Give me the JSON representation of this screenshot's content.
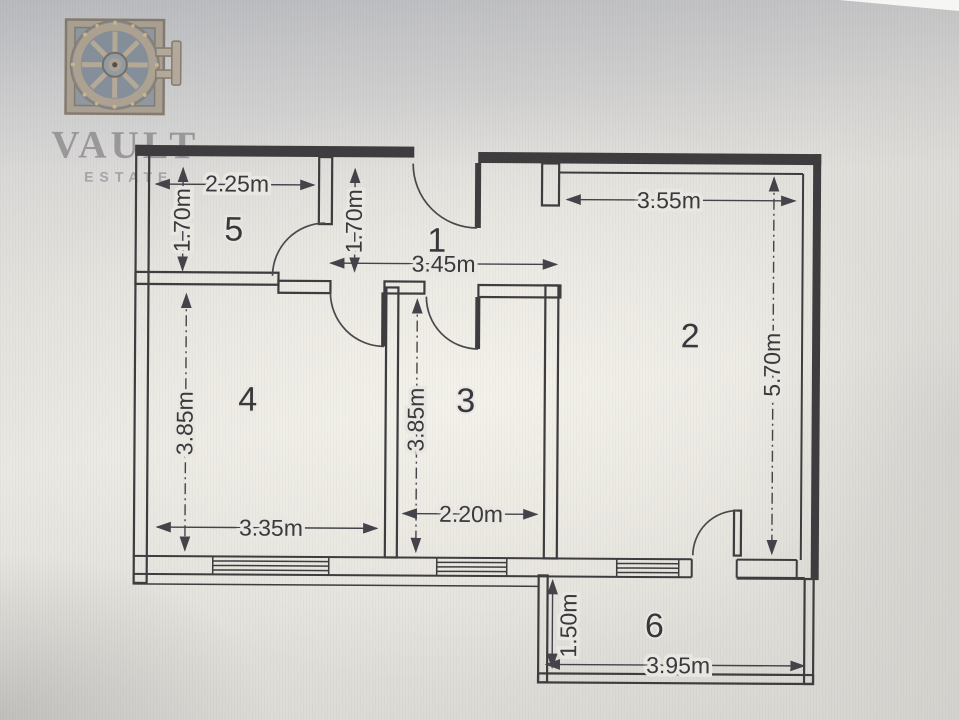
{
  "logo": {
    "brand": "VAULT",
    "sub": "ESTATE"
  },
  "floor_plan": {
    "unit": "m",
    "rooms": [
      {
        "number": "1",
        "label_x": 436,
        "label_y": 252
      },
      {
        "number": "2",
        "label_x": 690,
        "label_y": 346
      },
      {
        "number": "3",
        "label_x": 466,
        "label_y": 412
      },
      {
        "number": "4",
        "label_x": 248,
        "label_y": 412
      },
      {
        "number": "5",
        "label_x": 233,
        "label_y": 242
      },
      {
        "number": "6",
        "label_x": 656,
        "label_y": 636
      }
    ],
    "dimensions": [
      {
        "room": "5",
        "text": "2.25m",
        "x": 236,
        "y": 193,
        "rotate": 0
      },
      {
        "room": "5",
        "text": "1.70m",
        "x": 189,
        "y": 222,
        "rotate": -90
      },
      {
        "room": "1",
        "text": "1.70m",
        "x": 361,
        "y": 222,
        "rotate": -90
      },
      {
        "room": "1",
        "text": "3.45m",
        "x": 443,
        "y": 272,
        "rotate": 0
      },
      {
        "room": "2",
        "text": "3.55m",
        "x": 668,
        "y": 207,
        "rotate": 0
      },
      {
        "room": "2",
        "text": "5.70m",
        "x": 780,
        "y": 363,
        "rotate": -90
      },
      {
        "room": "4",
        "text": "3.85m",
        "x": 193,
        "y": 425,
        "rotate": -90
      },
      {
        "room": "4",
        "text": "3.35m",
        "x": 272,
        "y": 537,
        "rotate": 0
      },
      {
        "room": "3",
        "text": "3.85m",
        "x": 424,
        "y": 420,
        "rotate": -90
      },
      {
        "room": "3",
        "text": "2.20m",
        "x": 472,
        "y": 522,
        "rotate": 0
      },
      {
        "room": "6",
        "text": "1.50m",
        "x": 578,
        "y": 625,
        "rotate": -90
      },
      {
        "room": "6",
        "text": "3.95m",
        "x": 680,
        "y": 672,
        "rotate": 0
      }
    ]
  },
  "colors": {
    "ink": "#3e3c3e",
    "dim_ink": "#49474d",
    "paper": "#e9e7e1",
    "logo_frame": "#a79d90",
    "logo_face": "#7f8a95",
    "logo_text": "#8d8b8d"
  }
}
